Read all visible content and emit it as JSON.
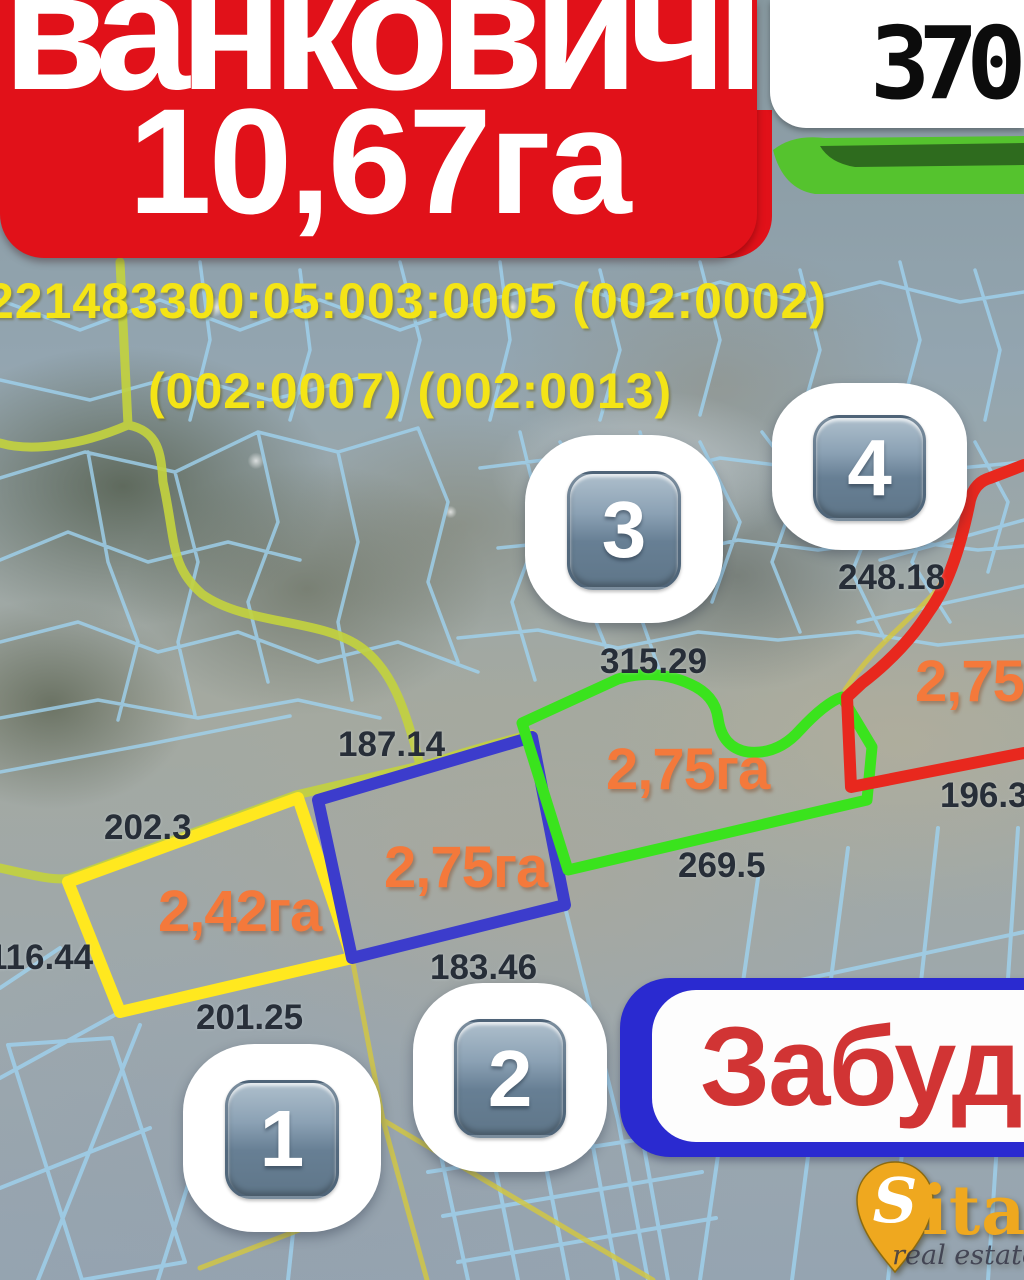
{
  "banner": {
    "title": "ванковичі",
    "area_total": "10,67га",
    "bg_color": "#e11119"
  },
  "price": {
    "value": "370"
  },
  "cadastral": {
    "line1": "221483300:05:003:0005 (002:0002)",
    "line2": "(002:0007) (002:0013)",
    "color": "#f4e416"
  },
  "plots": [
    {
      "number": "1",
      "area_label": "2,42га",
      "outline_color": "#ffe81f"
    },
    {
      "number": "2",
      "area_label": "2,75га",
      "outline_color": "#3c3ccc"
    },
    {
      "number": "3",
      "area_label": "2,75га",
      "outline_color": "#3ae31d"
    },
    {
      "number": "4",
      "area_label": "2,75га",
      "outline_color": "#e8281e"
    }
  ],
  "area_label_color": "#f4793b",
  "badges": [
    {
      "number": "1"
    },
    {
      "number": "2"
    },
    {
      "number": "3"
    },
    {
      "number": "4"
    }
  ],
  "measurements": [
    {
      "text": "315.29"
    },
    {
      "text": "248.18"
    },
    {
      "text": "187.14"
    },
    {
      "text": "202.3"
    },
    {
      "text": "116.44"
    },
    {
      "text": "201.25"
    },
    {
      "text": "183.46"
    },
    {
      "text": "269.5"
    },
    {
      "text": "196.3"
    }
  ],
  "overlay": {
    "development_label": "Забудова",
    "box_color": "#2a2ad0",
    "text_color": "#d13434"
  },
  "logo": {
    "brand_initial": "S",
    "brand_rest": "italo",
    "tagline": "real estate",
    "gold": "#efa81f"
  },
  "map": {
    "road_color": "#c2d13f",
    "parcel_line_color": "#9fd2ef",
    "ribbon_light": "#55c32e",
    "ribbon_dark": "#2e6b1e"
  }
}
